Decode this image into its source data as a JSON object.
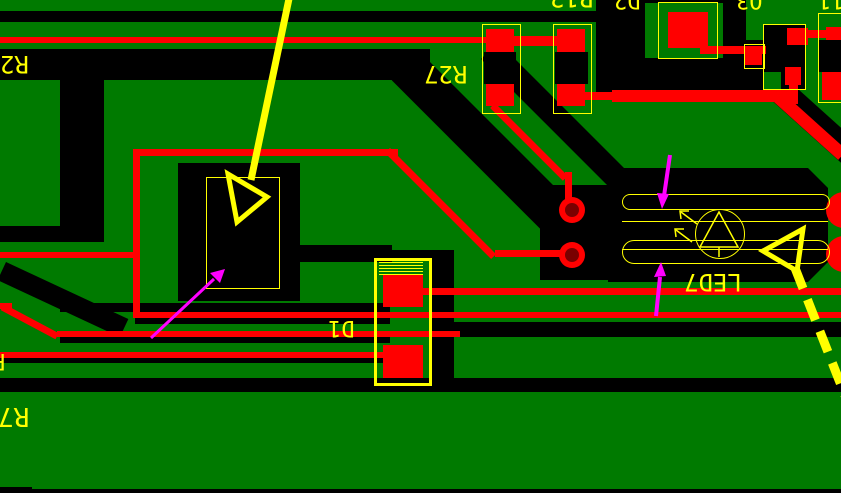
{
  "board": {
    "type": "pcb-layout-screenshot",
    "designators": {
      "r2": "R2",
      "r27": "R27",
      "r12": "R12",
      "d2": "D2",
      "q3": "Q3",
      "r11_partial": "11",
      "d1": "D1",
      "led7": "LED7",
      "r_partial": "R",
      "r7": "R7"
    },
    "colors": {
      "copper_pour": "#007A00",
      "clearance": "#000000",
      "top_trace": "#FF0000",
      "pad_hole": "#7A0000",
      "silkscreen": "#FFFF00",
      "highlight_arrow": "#FFFF00",
      "pointer_arrow": "#FF00FF"
    },
    "annotations": {
      "solid_yellow_arrow": "arrow-down-into-component-icon",
      "dashed_yellow_arrow": "arrow-up-left-at-led7-icon",
      "magenta_arrow_component": "pointer-arrow-icon",
      "magenta_arrow_led_top": "pointer-arrow-icon",
      "magenta_arrow_led_bottom": "pointer-arrow-icon",
      "led_symbol": "led-diode-symbol-icon"
    }
  }
}
